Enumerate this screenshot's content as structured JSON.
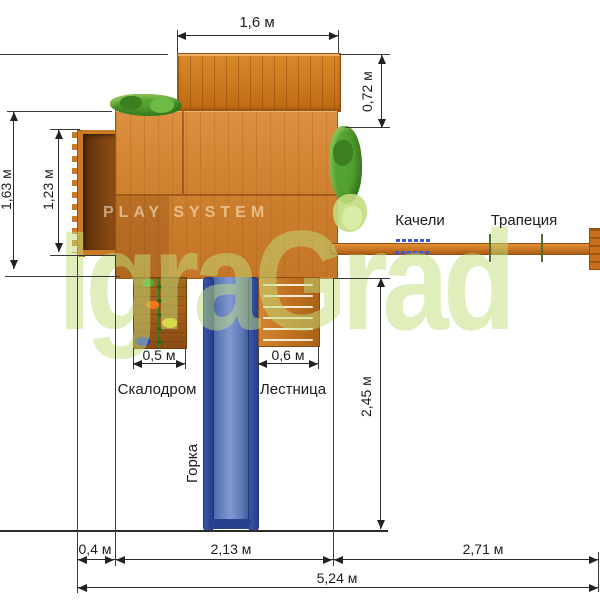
{
  "watermark": {
    "brand_top": "PLAY SYSTEM",
    "brand_main": "IgraGrad"
  },
  "labels": {
    "swing": "Качели",
    "trapeze": "Трапеция",
    "climbing_wall": "Скалодром",
    "ladder": "Лестница",
    "slide": "Горка"
  },
  "dimensions": {
    "roof_width": "1,6 м",
    "roof_depth": "0,72 м",
    "total_depth": "1,63 м",
    "balcony_depth": "1,23 м",
    "climbing_wall_width": "0,5 м",
    "ladder_width": "0,6 м",
    "slide_length": "2,45 м",
    "balcony_offset": "0,4 м",
    "platform_width": "2,13 м",
    "swing_section_width": "2,71 м",
    "total_width": "5,24 м"
  },
  "colors": {
    "wood_light": "#cd7e2c",
    "wood_roof": "#c06a12",
    "wood_dark_interior": "#5a2d09",
    "slide_blue": "#5d77b8",
    "slide_rail_blue": "#263f8c",
    "foliage_green": "#53a232",
    "foliage_light": "#c2db80",
    "watermark_green": "#c1de79",
    "line_color": "#2b2b2b",
    "hold_green": "#4caf30",
    "hold_orange": "#f07818",
    "hold_yellow": "#ead51c",
    "hold_blue": "#2038d8",
    "swing_mark_blue": "#3b55d4"
  }
}
